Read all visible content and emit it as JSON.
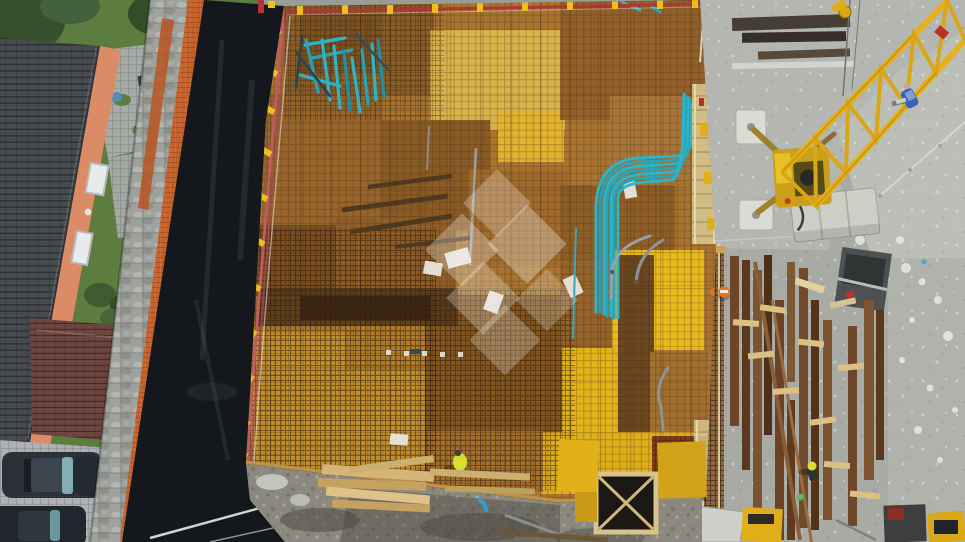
{
  "scene": {
    "kind": "aerial-drone-photograph",
    "subject": "construction site: plywood formwork deck with rebar mesh, self-erecting crane, neighboring house, lumber yard"
  },
  "palette": {
    "grass_green": "#5c7c40",
    "roof_slate": "#474b4f",
    "facade_orange": "#db8c66",
    "garage_roof": "#6e4641",
    "pavement_gray": "#aeb1b2",
    "stone_wall": "#9fa29c",
    "safety_fence_orange": "#c85f26",
    "tarp_black": "#14171b",
    "deck_plywood": "#a9742f",
    "formwork_yellow": "#e5b31c",
    "conduit_teal": "#2fb3c6",
    "guardrail_red": "#b23434",
    "guardrail_pink": "#c05a64",
    "bracket_yellow": "#e9c01c",
    "concrete_gray": "#a8aba4",
    "concrete_light": "#bcbfb8",
    "crane_yellow": "#e7b11c",
    "ballast_gray": "#cccfc6",
    "lumber_brown": "#6e462a",
    "lumber_light": "#dcc084",
    "hivis_yellow": "#d9df2e",
    "worker_blue": "#3a63b8",
    "gravel_gray": "#8b887e",
    "car_dark": "#2b3138",
    "windshield_teal": "#8fc2c6",
    "cone_orange": "#e2741c",
    "watermark_white": "#ffffff"
  },
  "objects": [
    "house-roof",
    "orange-facade",
    "stone-patio",
    "garage-roof",
    "parked-cars",
    "boundary-stone-wall",
    "orange-safety-fence",
    "black-foundation-tarp",
    "formwork-deck",
    "rebar-mesh",
    "blue-conduit-bundle",
    "blue-rod-pile",
    "deck-guardrails",
    "deck-worker",
    "concrete-yard",
    "tower-crane",
    "crane-ballast",
    "crane-outrigger-pads",
    "worker-blue-shirt",
    "lumber-storage",
    "traffic-cone",
    "site-machines",
    "gravel-strip",
    "lumber-stack",
    "shaft-opening",
    "watermark-logo"
  ]
}
